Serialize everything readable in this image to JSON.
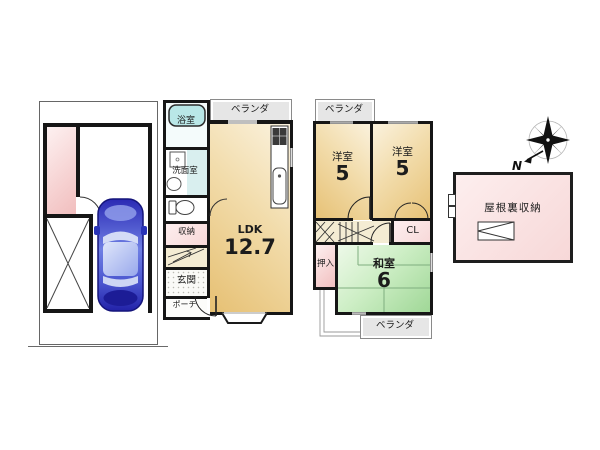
{
  "plan": {
    "floor1": {
      "veranda": "ベランダ",
      "bath": "浴室",
      "washroom": "洗面室",
      "storage": "収納",
      "entrance": "玄関",
      "porch": "ポーチ",
      "ldk_name": "LDK",
      "ldk_size": "12.7"
    },
    "floor2": {
      "veranda_top": "ベランダ",
      "veranda_bottom": "ベランダ",
      "western1_name": "洋室",
      "western1_size": "5",
      "western2_name": "洋室",
      "western2_size": "5",
      "closet": "CL",
      "oshiire": "押入",
      "washitsu_name": "和室",
      "washitsu_size": "6"
    },
    "attic": {
      "label": "屋根裏収納"
    },
    "compass": {
      "north": "N"
    },
    "colors": {
      "room_tan": "#e6c073",
      "room_tan_light": "#fbf3e0",
      "tatami_green": "#9fd796",
      "tatami_green_light": "#eef9e9",
      "pink": "#f1bebe",
      "veranda_gray": "#e6e6e6",
      "bath_cyan": "#b9e7e7",
      "car_blue": "#3434bd"
    }
  }
}
